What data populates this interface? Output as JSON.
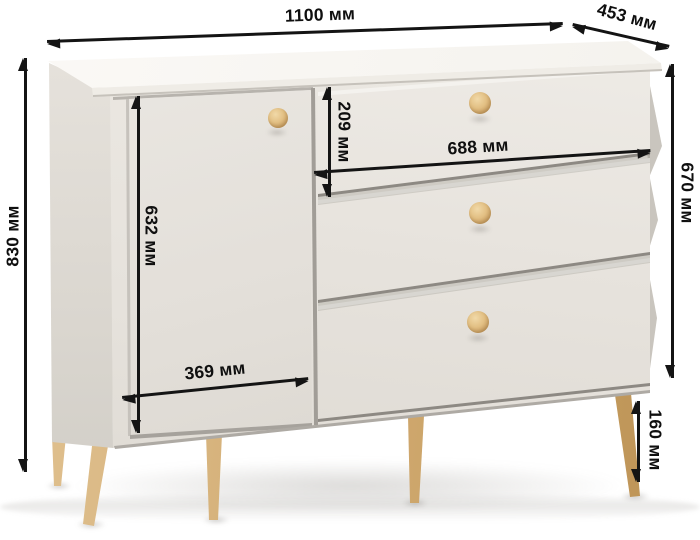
{
  "unit": "мм",
  "dimensions": {
    "width": {
      "value": 1100,
      "label": "1100 мм"
    },
    "depth": {
      "value": 453,
      "label": "453 мм"
    },
    "height": {
      "value": 830,
      "label": "830 мм"
    },
    "body_height": {
      "value": 670,
      "label": "670 мм"
    },
    "drawer_front_height": {
      "value": 209,
      "label": "209 мм"
    },
    "drawer_width": {
      "value": 688,
      "label": "688 мм"
    },
    "door_height": {
      "value": 632,
      "label": "632 мм"
    },
    "door_width": {
      "value": 369,
      "label": "369 мм"
    },
    "leg_height": {
      "value": 160,
      "label": "160 мм"
    }
  },
  "furniture": {
    "kind": "chest-of-drawers",
    "drawer_count": 3,
    "door_count": 1,
    "knob_count": 4,
    "visible_leg_count": 5
  },
  "colors": {
    "background": "#ffffff",
    "body": "#e9e6e0",
    "top": "#f7f5f1",
    "side": "#ddd9d2",
    "wood_accent": "#d2ab71",
    "dimension_lines": "#141414"
  }
}
